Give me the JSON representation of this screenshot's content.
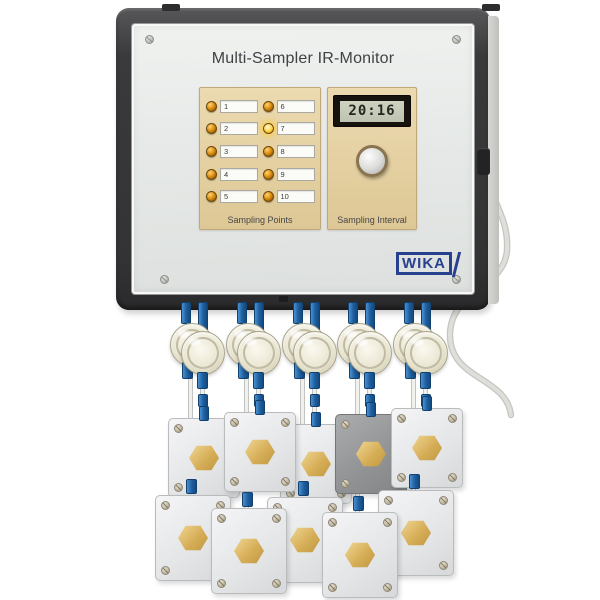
{
  "device": {
    "title": "Multi-Sampler IR-Monitor",
    "brand": "WIKA"
  },
  "sampling_points": {
    "label": "Sampling Points",
    "items": [
      {
        "number": "1",
        "lit": false
      },
      {
        "number": "2",
        "lit": false
      },
      {
        "number": "3",
        "lit": false
      },
      {
        "number": "4",
        "lit": false
      },
      {
        "number": "5",
        "lit": false
      },
      {
        "number": "6",
        "lit": false
      },
      {
        "number": "7",
        "lit": true
      },
      {
        "number": "8",
        "lit": false
      },
      {
        "number": "9",
        "lit": false
      },
      {
        "number": "10",
        "lit": false
      }
    ]
  },
  "sampling_interval": {
    "label": "Sampling Interval",
    "display_value": "20:16"
  },
  "colors": {
    "enclosure_frame": "#3a3a3c",
    "front_panel": "#e8eae8",
    "sub_panel_beige": "#e5d2a6",
    "led_off": "#c8831a",
    "led_on": "#ffd84e",
    "lcd_background": "#c6cab9",
    "lcd_digits": "#24271f",
    "brand_blue": "#27418e",
    "fitting_blue": "#1d5d9d",
    "brass": "#d7ae58",
    "sensor_box_white": "#e9ebec",
    "sensor_box_gray": "#909294"
  }
}
